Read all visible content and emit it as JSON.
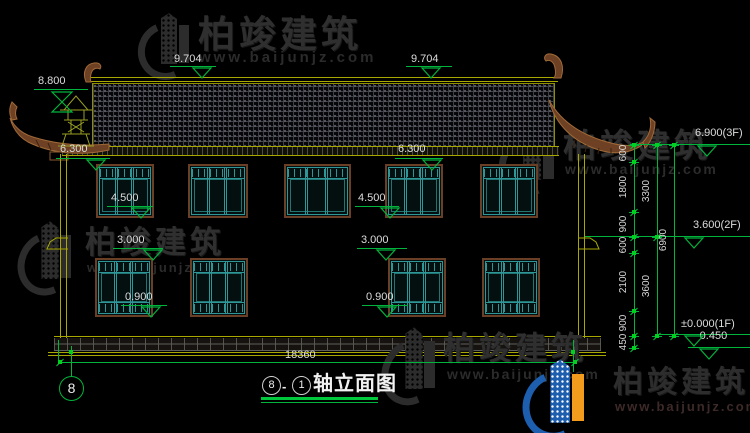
{
  "watermark": {
    "brand": "柏竣建筑",
    "url": "www.baijunjz.com"
  },
  "levels": {
    "finial": "8.800",
    "ridge": "9.704",
    "eave": "6.300",
    "upper_sill": "4.500",
    "lower_head": "3.000",
    "lower_sill": "0.900"
  },
  "floor_levels": {
    "f3": "6.900(3F)",
    "f2": "3.600(2F)",
    "f1": "±0.000(1F)",
    "base": "-0.450"
  },
  "dims": {
    "col1": [
      "600",
      "1800",
      "900",
      "600",
      "2100",
      "900",
      "450"
    ],
    "col2": [
      "3300",
      "3600"
    ],
    "col3": [
      "6900"
    ],
    "total_width": "18360"
  },
  "axis": {
    "left": "8"
  },
  "title": {
    "start": "8",
    "sep": "-",
    "end": "1",
    "name": "轴立面图"
  },
  "colors": {
    "line_yellow": "#a8a800",
    "dim_green": "#00b43c",
    "lattice_teal": "#2e9696",
    "frame_brown": "#6b3f26",
    "logo_blue": "#1d5fae",
    "logo_orange": "#f29b1d"
  }
}
